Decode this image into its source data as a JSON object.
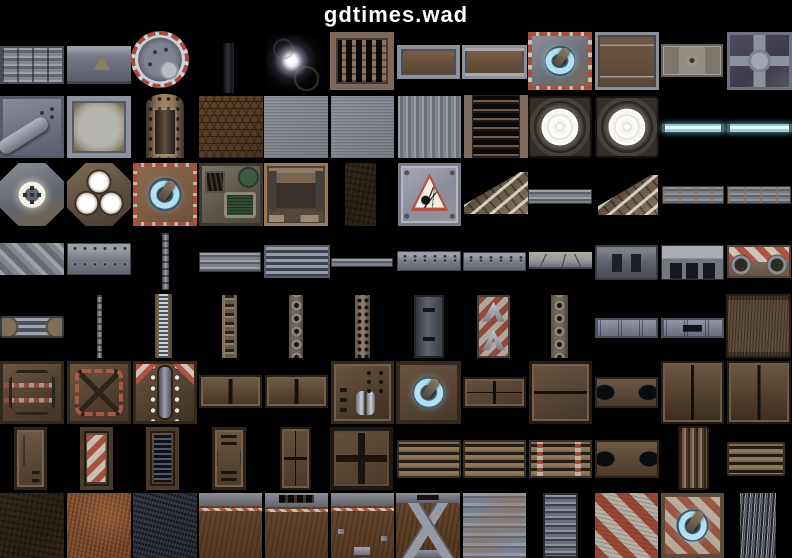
{
  "header": {
    "title": "gdtimes.wad"
  },
  "colors": {
    "background": "#000000",
    "title_text": "#ffffff",
    "glow_cyan": "#b2e2f2",
    "hazard_red": "#a8503e",
    "rust_brown": "#66503c",
    "metal_gray": "#7e8088"
  },
  "textures": [
    {
      "name": "ribbed-metal",
      "kind": "ridges",
      "x": 0,
      "y": 46,
      "w": 64,
      "h": 38
    },
    {
      "name": "warning-band",
      "kind": "warnband",
      "x": 67,
      "y": 46,
      "w": 64,
      "h": 38
    },
    {
      "name": "round-hatch",
      "kind": "manhole",
      "x": 131,
      "y": 31,
      "w": 58,
      "h": 57
    },
    {
      "name": "dark-strip",
      "kind": "darkstrip",
      "x": 223,
      "y": 43,
      "w": 11,
      "h": 50
    },
    {
      "name": "lens-flare",
      "kind": "flare",
      "x": 266,
      "y": 35,
      "w": 58,
      "h": 56
    },
    {
      "name": "wall-grate",
      "kind": "grate",
      "x": 330,
      "y": 32,
      "w": 64,
      "h": 58
    },
    {
      "name": "rust-plate",
      "kind": "rustpanel",
      "x": 397,
      "y": 45,
      "w": 63,
      "h": 34
    },
    {
      "name": "rust-plate-rails",
      "kind": "rustpanel2",
      "x": 462,
      "y": 45,
      "w": 65,
      "h": 34
    },
    {
      "name": "power-panel-gray",
      "kind": "qgray",
      "x": 528,
      "y": 32,
      "w": 64,
      "h": 58
    },
    {
      "name": "rust-door-panel",
      "kind": "rustpanel3",
      "x": 595,
      "y": 32,
      "w": 64,
      "h": 58
    },
    {
      "name": "rivet-plate-small",
      "kind": "smallpanel",
      "x": 661,
      "y": 44,
      "w": 62,
      "h": 33
    },
    {
      "name": "cross-brace-panel",
      "kind": "crosspanel",
      "x": 727,
      "y": 32,
      "w": 65,
      "h": 58
    },
    {
      "name": "pipe-panel",
      "kind": "graypipe",
      "x": 0,
      "y": 96,
      "w": 64,
      "h": 62
    },
    {
      "name": "plaster-plate",
      "kind": "plaster",
      "x": 67,
      "y": 96,
      "w": 64,
      "h": 62
    },
    {
      "name": "tech-pillar",
      "kind": "pillar",
      "x": 133,
      "y": 92,
      "w": 64,
      "h": 66
    },
    {
      "name": "hex-mesh",
      "kind": "hex",
      "x": 199,
      "y": 96,
      "w": 64,
      "h": 62
    },
    {
      "name": "gray-plate-a",
      "kind": "graynoise",
      "x": 264,
      "y": 96,
      "w": 64,
      "h": 62
    },
    {
      "name": "gray-plate-b",
      "kind": "graynoise",
      "x": 331,
      "y": 96,
      "w": 63,
      "h": 62
    },
    {
      "name": "corrugated-wall",
      "kind": "corrug",
      "x": 398,
      "y": 96,
      "w": 63,
      "h": 62
    },
    {
      "name": "ladder-vent",
      "kind": "laddervent",
      "x": 464,
      "y": 95,
      "w": 64,
      "h": 63
    },
    {
      "name": "flood-light-a",
      "kind": "lamp",
      "x": 528,
      "y": 96,
      "w": 64,
      "h": 62
    },
    {
      "name": "flood-light-b",
      "kind": "lamp",
      "x": 595,
      "y": 96,
      "w": 64,
      "h": 62
    },
    {
      "name": "light-strip-a",
      "kind": "lightbar",
      "x": 662,
      "y": 124,
      "w": 62,
      "h": 8
    },
    {
      "name": "light-strip-b",
      "kind": "lightbar",
      "x": 727,
      "y": 124,
      "w": 65,
      "h": 8
    },
    {
      "name": "octagon-ring-light",
      "kind": "octring",
      "x": 0,
      "y": 163,
      "w": 64,
      "h": 63
    },
    {
      "name": "octagon-triple-light",
      "kind": "octlights",
      "x": 67,
      "y": 163,
      "w": 64,
      "h": 63
    },
    {
      "name": "power-panel-rust",
      "kind": "qrust",
      "x": 133,
      "y": 163,
      "w": 64,
      "h": 63
    },
    {
      "name": "console-screen",
      "kind": "console",
      "x": 199,
      "y": 163,
      "w": 64,
      "h": 63
    },
    {
      "name": "alcove-panel",
      "kind": "alcove",
      "x": 264,
      "y": 163,
      "w": 64,
      "h": 63
    },
    {
      "name": "dark-rock",
      "kind": "darkrough",
      "x": 345,
      "y": 163,
      "w": 31,
      "h": 63
    },
    {
      "name": "explosive-sign",
      "kind": "warnsign",
      "x": 398,
      "y": 163,
      "w": 63,
      "h": 63
    },
    {
      "name": "stair-edge-small",
      "kind": "stair",
      "x": 464,
      "y": 172,
      "w": 64,
      "h": 42
    },
    {
      "name": "strip-rails",
      "kind": "hstrips",
      "x": 528,
      "y": 189,
      "w": 64,
      "h": 15
    },
    {
      "name": "stair-steps",
      "kind": "stair",
      "x": 598,
      "y": 175,
      "w": 60,
      "h": 40
    },
    {
      "name": "girder-band-a",
      "kind": "sepband",
      "x": 662,
      "y": 186,
      "w": 62,
      "h": 18
    },
    {
      "name": "girder-band-b",
      "kind": "sepband",
      "x": 727,
      "y": 186,
      "w": 64,
      "h": 18
    },
    {
      "name": "diagonal-plating",
      "kind": "diagmetal",
      "x": 0,
      "y": 243,
      "w": 64,
      "h": 32
    },
    {
      "name": "rivet-girder",
      "kind": "rivetband",
      "x": 67,
      "y": 243,
      "w": 64,
      "h": 32
    },
    {
      "name": "support-pole",
      "kind": "polev",
      "x": 162,
      "y": 233,
      "w": 7,
      "h": 57
    },
    {
      "name": "rail-strip",
      "kind": "hstrips",
      "x": 199,
      "y": 252,
      "w": 62,
      "h": 20
    },
    {
      "name": "striped-girder",
      "kind": "stripeband",
      "x": 264,
      "y": 245,
      "w": 66,
      "h": 33
    },
    {
      "name": "thin-ledge",
      "kind": "hstrips",
      "x": 331,
      "y": 258,
      "w": 62,
      "h": 9
    },
    {
      "name": "slotted-rail",
      "kind": "rivetband",
      "x": 397,
      "y": 251,
      "w": 64,
      "h": 20
    },
    {
      "name": "pipe-rail",
      "kind": "rivetband",
      "x": 463,
      "y": 252,
      "w": 63,
      "h": 19
    },
    {
      "name": "notched-girder",
      "kind": "notchband",
      "x": 529,
      "y": 252,
      "w": 63,
      "h": 17
    },
    {
      "name": "slot-girder",
      "kind": "slotband",
      "x": 595,
      "y": 245,
      "w": 63,
      "h": 35
    },
    {
      "name": "cutout-girder",
      "kind": "cutband",
      "x": 661,
      "y": 245,
      "w": 63,
      "h": 35
    },
    {
      "name": "hazard-gear-band",
      "kind": "hazgear",
      "x": 727,
      "y": 245,
      "w": 64,
      "h": 33
    },
    {
      "name": "pipe-coupling",
      "kind": "pipejoint",
      "x": 0,
      "y": 316,
      "w": 64,
      "h": 22
    },
    {
      "name": "thin-chain",
      "kind": "polev",
      "x": 97,
      "y": 295,
      "w": 5,
      "h": 63
    },
    {
      "name": "coil-strut",
      "kind": "coilv",
      "x": 155,
      "y": 294,
      "w": 17,
      "h": 64
    },
    {
      "name": "chain-strut",
      "kind": "chainv",
      "x": 222,
      "y": 295,
      "w": 15,
      "h": 63
    },
    {
      "name": "socket-strut",
      "kind": "ringsv",
      "x": 289,
      "y": 295,
      "w": 14,
      "h": 63
    },
    {
      "name": "dotted-strut",
      "kind": "dotsv",
      "x": 355,
      "y": 295,
      "w": 15,
      "h": 63
    },
    {
      "name": "slotted-column",
      "kind": "slotv",
      "x": 414,
      "y": 295,
      "w": 30,
      "h": 63
    },
    {
      "name": "hazard-arrow-column",
      "kind": "arrowhaz",
      "x": 477,
      "y": 295,
      "w": 33,
      "h": 63
    },
    {
      "name": "ring-column",
      "kind": "ringsv",
      "x": 551,
      "y": 295,
      "w": 17,
      "h": 63
    },
    {
      "name": "riveted-girder-blue",
      "kind": "bluband",
      "x": 595,
      "y": 318,
      "w": 63,
      "h": 20
    },
    {
      "name": "slotted-girder-blue",
      "kind": "blubandslot",
      "x": 661,
      "y": 318,
      "w": 63,
      "h": 20
    },
    {
      "name": "rough-hide-panel",
      "kind": "fur",
      "x": 726,
      "y": 294,
      "w": 65,
      "h": 64
    },
    {
      "name": "brown-octagon-panel",
      "kind": "boct",
      "x": 0,
      "y": 361,
      "w": 64,
      "h": 63
    },
    {
      "name": "brown-cross-panel",
      "kind": "bx",
      "x": 67,
      "y": 361,
      "w": 64,
      "h": 63
    },
    {
      "name": "mech-door-panel",
      "kind": "bmech",
      "x": 133,
      "y": 361,
      "w": 64,
      "h": 63
    },
    {
      "name": "double-plate-a",
      "kind": "b2sq",
      "x": 199,
      "y": 375,
      "w": 63,
      "h": 33
    },
    {
      "name": "double-plate-b",
      "kind": "b2sq",
      "x": 265,
      "y": 375,
      "w": 63,
      "h": 33
    },
    {
      "name": "piston-panel",
      "kind": "btubes",
      "x": 331,
      "y": 361,
      "w": 63,
      "h": 63
    },
    {
      "name": "power-panel-brown",
      "kind": "qbrown",
      "x": 396,
      "y": 361,
      "w": 65,
      "h": 63
    },
    {
      "name": "quad-plate-band",
      "kind": "b4sq",
      "x": 463,
      "y": 377,
      "w": 63,
      "h": 31
    },
    {
      "name": "split-plate",
      "kind": "b2h",
      "x": 529,
      "y": 361,
      "w": 63,
      "h": 63
    },
    {
      "name": "oval-vent-band-a",
      "kind": "ovalvent",
      "x": 595,
      "y": 377,
      "w": 63,
      "h": 31
    },
    {
      "name": "twin-column-plate-a",
      "kind": "b2col",
      "x": 661,
      "y": 361,
      "w": 63,
      "h": 63
    },
    {
      "name": "twin-column-plate-b",
      "kind": "b2col",
      "x": 727,
      "y": 361,
      "w": 64,
      "h": 63
    },
    {
      "name": "narrow-door",
      "kind": "bdoor",
      "x": 14,
      "y": 427,
      "w": 33,
      "h": 63
    },
    {
      "name": "hazard-door",
      "kind": "hazdoor",
      "x": 80,
      "y": 427,
      "w": 33,
      "h": 63
    },
    {
      "name": "vent-door",
      "kind": "ventdoor",
      "x": 146,
      "y": 427,
      "w": 33,
      "h": 63
    },
    {
      "name": "tech-door",
      "kind": "techdoor",
      "x": 212,
      "y": 427,
      "w": 34,
      "h": 63
    },
    {
      "name": "quad-plate-door",
      "kind": "b4sq",
      "x": 280,
      "y": 427,
      "w": 31,
      "h": 63
    },
    {
      "name": "bolted-quad-plate",
      "kind": "plate4",
      "x": 330,
      "y": 427,
      "w": 63,
      "h": 63
    },
    {
      "name": "slat-band-a",
      "kind": "slatband",
      "x": 397,
      "y": 440,
      "w": 64,
      "h": 38
    },
    {
      "name": "slat-band-b",
      "kind": "slatband",
      "x": 463,
      "y": 440,
      "w": 63,
      "h": 38
    },
    {
      "name": "slat-band-hazard",
      "kind": "slathaz",
      "x": 529,
      "y": 440,
      "w": 63,
      "h": 38
    },
    {
      "name": "oval-vent-band-b",
      "kind": "ovalvent",
      "x": 595,
      "y": 440,
      "w": 64,
      "h": 38
    },
    {
      "name": "grooved-column",
      "kind": "grooves",
      "x": 678,
      "y": 426,
      "w": 31,
      "h": 64
    },
    {
      "name": "slat-band-c",
      "kind": "slatband",
      "x": 727,
      "y": 442,
      "w": 58,
      "h": 34
    },
    {
      "name": "dark-dirt",
      "kind": "darkrough",
      "x": 0,
      "y": 493,
      "w": 64,
      "h": 65
    },
    {
      "name": "rust-dirt",
      "kind": "rustrough",
      "x": 67,
      "y": 493,
      "w": 64,
      "h": 65
    },
    {
      "name": "dark-speckle",
      "kind": "darkspeckle",
      "x": 133,
      "y": 493,
      "w": 64,
      "h": 65
    },
    {
      "name": "rust-wall-girder",
      "kind": "rwallg",
      "x": 199,
      "y": 493,
      "w": 63,
      "h": 65
    },
    {
      "name": "rust-wall-vent",
      "kind": "rwallv",
      "x": 265,
      "y": 493,
      "w": 63,
      "h": 65
    },
    {
      "name": "rust-wall-bracket",
      "kind": "rwallb",
      "x": 331,
      "y": 493,
      "w": 63,
      "h": 65
    },
    {
      "name": "truss-wall",
      "kind": "truss",
      "x": 396,
      "y": 493,
      "w": 64,
      "h": 65
    },
    {
      "name": "blue-corrugated",
      "kind": "bluecorr",
      "x": 463,
      "y": 493,
      "w": 63,
      "h": 65
    },
    {
      "name": "banded-column",
      "kind": "bandv",
      "x": 543,
      "y": 493,
      "w": 35,
      "h": 65
    },
    {
      "name": "hazard-stripes",
      "kind": "hazdiag",
      "x": 595,
      "y": 493,
      "w": 63,
      "h": 65
    },
    {
      "name": "power-panel-hazard",
      "kind": "qhaz",
      "x": 661,
      "y": 493,
      "w": 63,
      "h": 65
    },
    {
      "name": "cable-bundle",
      "kind": "wires",
      "x": 740,
      "y": 493,
      "w": 36,
      "h": 65
    }
  ]
}
